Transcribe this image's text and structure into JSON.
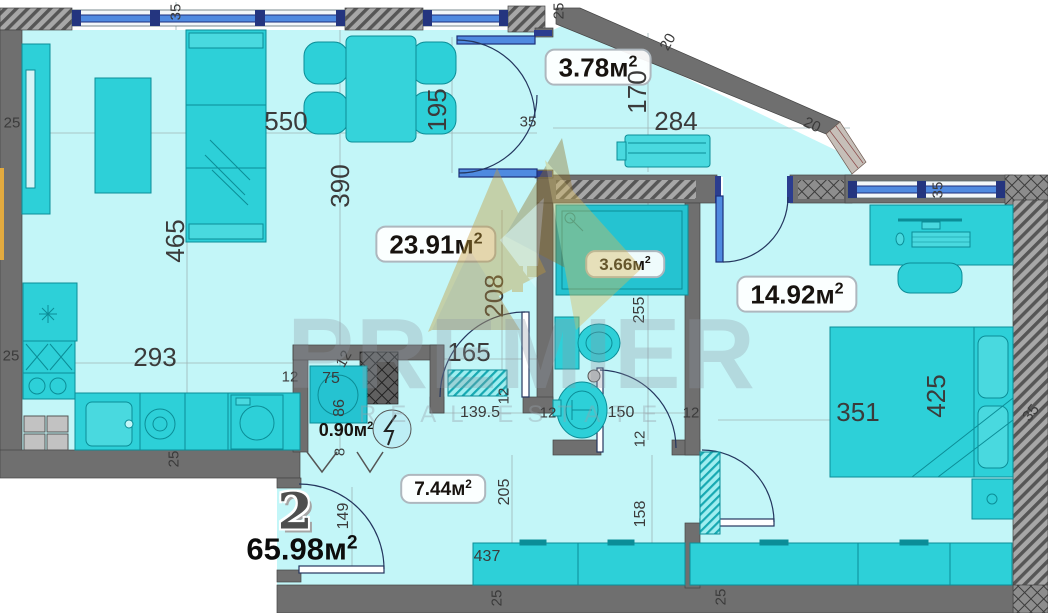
{
  "plan": {
    "unit": {
      "number": "2",
      "total_area": "65.98"
    },
    "area_unit": "м",
    "area_sup": "2",
    "watermark": {
      "brand": "PREMIER",
      "subtitle": "REAL ESTATE"
    },
    "rooms": {
      "living": {
        "area": "23.91"
      },
      "balcony": {
        "area": "3.78"
      },
      "bathroom": {
        "area": "3.66"
      },
      "bedroom": {
        "area": "14.92"
      },
      "closet": {
        "area": "0.90"
      },
      "hallway": {
        "area": "7.44"
      }
    },
    "dims": {
      "living_width_550": "550",
      "living_depth_390": "390",
      "living_left_465": "465",
      "kitchen_293": "293",
      "top_wall_35": "35",
      "left_upper_25": "25",
      "left_lower_25": "25",
      "kitchen_bottom_25": "25",
      "kitchen_right_12": "12",
      "closet_75": "75",
      "closet_86": "86",
      "closet_wall_12": "12",
      "closet_door_8": "8",
      "balcony_door_195": "195",
      "balcony_door_wall_35": "35",
      "balcony_top_25": "25",
      "diagonal_wall_20": "20",
      "diagonal_window_20": "20",
      "balcony_170": "170",
      "balcony_284": "284",
      "bedroom_window_35": "35",
      "living_opening_208": "208",
      "living_opening_165": "165",
      "hall_width_139_5": "139.5",
      "hall_wall_12_a": "12",
      "bath_door_150": "150",
      "hall_wall_12_b": "12",
      "bath_255": "255",
      "hall_wall_12_c": "12",
      "hall_length_205": "205",
      "hall_right_158": "158",
      "bedroom_door_12": "12",
      "entry_door_149": "149",
      "hall_cabinet_437": "437",
      "bottom_left_25": "25",
      "bottom_right_25": "25",
      "bedroom_351": "351",
      "bedroom_425": "425",
      "right_wall_35": "35"
    }
  }
}
